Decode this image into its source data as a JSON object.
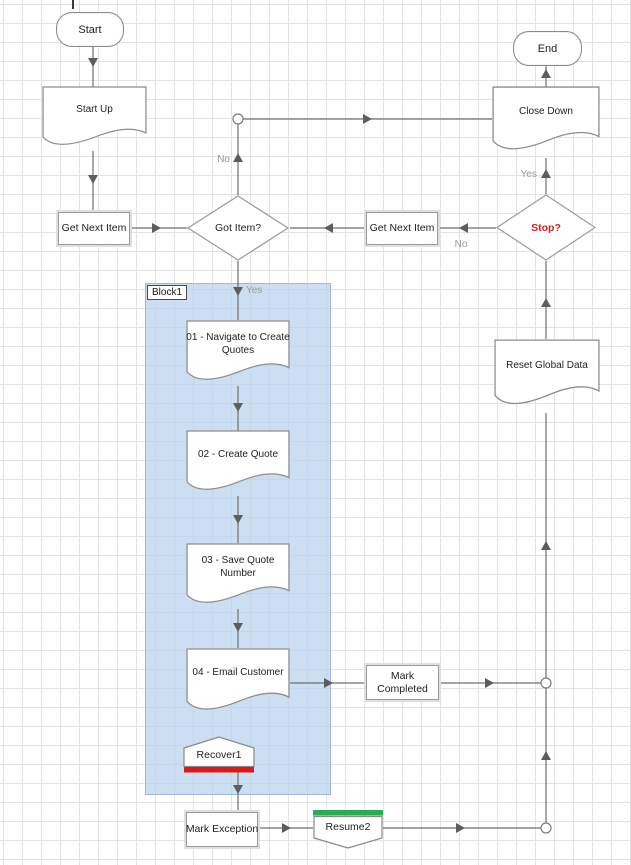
{
  "diagram": {
    "nodes": {
      "start": {
        "label": "Start",
        "type": "terminator"
      },
      "start_up": {
        "label": "Start Up",
        "type": "page"
      },
      "get_next_item_left": {
        "label": "Get Next Item",
        "type": "action"
      },
      "got_item": {
        "label": "Got Item?",
        "type": "decision"
      },
      "block1": {
        "label": "Block1",
        "type": "block"
      },
      "step_01": {
        "label": "01 - Navigate to Create Quotes",
        "type": "page"
      },
      "step_02": {
        "label": "02 - Create Quote",
        "type": "page"
      },
      "step_03": {
        "label": "03 - Save Quote Number",
        "type": "page"
      },
      "step_04": {
        "label": "04 - Email Customer",
        "type": "page"
      },
      "recover1": {
        "label": "Recover1",
        "type": "recover"
      },
      "mark_exception": {
        "label": "Mark Exception",
        "type": "action"
      },
      "resume2": {
        "label": "Resume2",
        "type": "resume"
      },
      "mark_completed": {
        "label": "Mark Completed",
        "type": "action"
      },
      "get_next_item_right": {
        "label": "Get Next Item",
        "type": "action"
      },
      "stop": {
        "label": "Stop?",
        "type": "decision"
      },
      "reset_global_data": {
        "label": "Reset Global Data",
        "type": "page"
      },
      "close_down": {
        "label": "Close Down",
        "type": "page"
      },
      "end": {
        "label": "End",
        "type": "terminator"
      }
    },
    "edge_labels": {
      "got_item_no": "No",
      "got_item_yes": "Yes",
      "stop_yes": "Yes",
      "stop_no": "No"
    },
    "colors": {
      "block_fill": "rgba(183,209,237,0.72)",
      "recover_bar": "#e01717",
      "resume_bar": "#27ae4f",
      "stop_text": "#cf2121",
      "connector": "#6f6f6f",
      "grid_line": "#e3e3e3"
    }
  }
}
